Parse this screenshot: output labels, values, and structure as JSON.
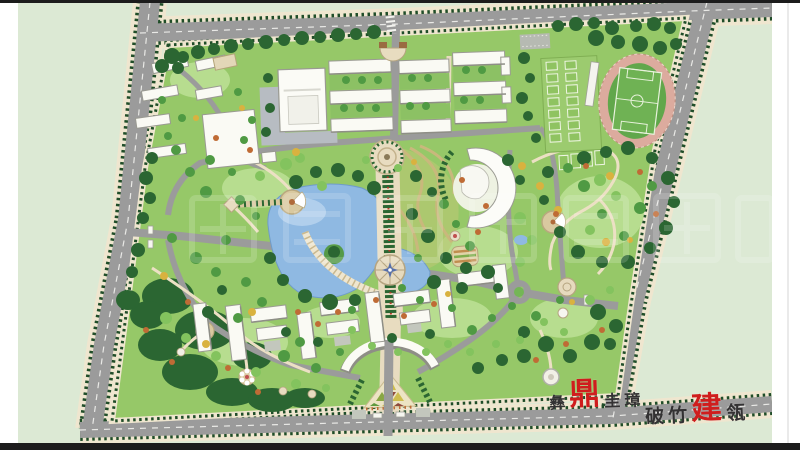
{
  "canvas": {
    "width": 800,
    "height": 450,
    "outer_margin_color": "#ffffff",
    "frame_bar_color": "#1c1c1c",
    "ground_color": "#dce9d4"
  },
  "palette": {
    "road": "#9b9b9b",
    "sidewalk": "#efe6cf",
    "hedge": "#1f4d28",
    "lawn": "#96c868",
    "lawn_light": "#b7dd8f",
    "forest": "#2b6632",
    "tree_mid": "#4f9a43",
    "tree_light": "#83c35e",
    "tree_yellow": "#d9b23f",
    "tree_orange": "#bf6b35",
    "water": "#8fb9e2",
    "water_light": "#b9d4ef",
    "track": "#dcab9e",
    "pitch": "#61a74b",
    "courts": "#9ccb6f",
    "building": "#fafaf4",
    "building_shadow": "#8e8e86",
    "plaza": "#e8dcc0",
    "plaza_ring": "#b5a480",
    "seal_ink": "#333233",
    "seal_red": "#cf1d1d",
    "watermark": "#ffffff"
  },
  "seals": {
    "line1": {
      "chars": [
        {
          "text": "彝",
          "variant": "ink"
        },
        {
          "text": "鼎",
          "variant": "red"
        },
        {
          "text": "圭",
          "variant": "ink"
        },
        {
          "text": "璋",
          "variant": "ink"
        }
      ]
    },
    "line2": {
      "chars": [
        {
          "text": "破",
          "variant": "ink"
        },
        {
          "text": "竹",
          "variant": "ink"
        },
        {
          "text": "建",
          "variant": "red"
        },
        {
          "text": "瓴",
          "variant": "ink"
        }
      ]
    }
  },
  "watermark": {
    "legible": false,
    "style": "large translucent white characters across the center of the plan"
  },
  "map_features": [
    "perimeter-roads",
    "campus-boundary-hedge",
    "northwest-residential-cluster",
    "gymnasium",
    "dormitory-rows",
    "basketball-court-grid",
    "running-track",
    "soccer-field",
    "grandstand",
    "central-axis-boulevard",
    "north-entrance",
    "circular-plaza",
    "compass-plaza",
    "lake",
    "lakeside-terrace",
    "crescent-library",
    "terraced-garden",
    "parterre-bed",
    "east-park",
    "fan-pavilion-plazas",
    "ring-road",
    "roundabout",
    "east-entrance",
    "west-entrance",
    "teaching-building-cluster",
    "arc-gateway-building",
    "triangle-mosaic-plaza",
    "south-entrance",
    "southwest-forest-park",
    "flower-plaza",
    "compass-node",
    "sculpture-plaza"
  ]
}
